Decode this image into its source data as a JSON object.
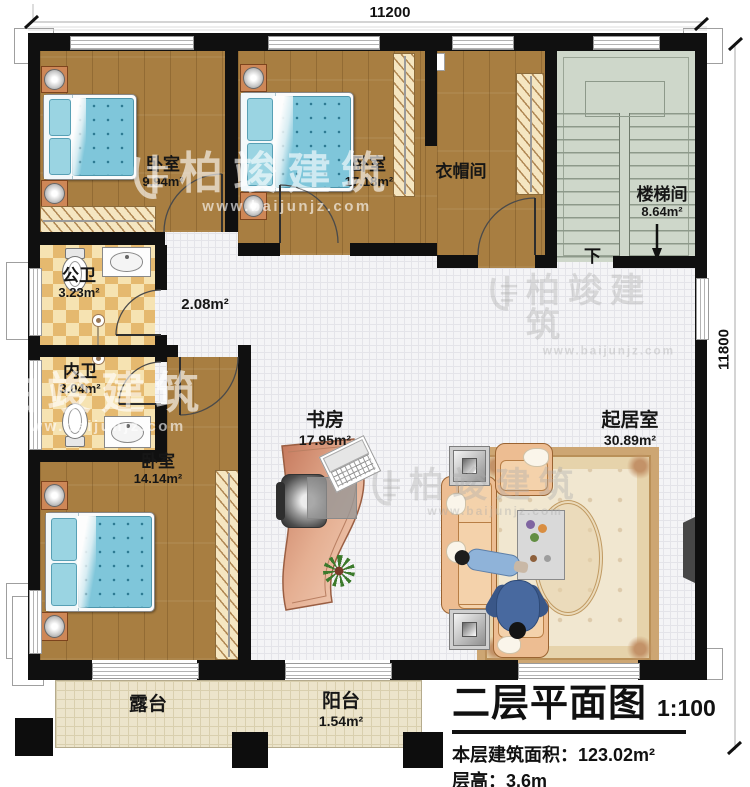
{
  "dimensions": {
    "top": "11200",
    "right": "11800"
  },
  "rooms": {
    "bedroom1": {
      "name": "卧室",
      "area": "9.94m²"
    },
    "bedroom2": {
      "name": "卧室",
      "area": "17.18m²"
    },
    "cloakroom": {
      "name": "衣帽间",
      "area": ""
    },
    "stairwell": {
      "name": "楼梯间",
      "area": "8.64m²"
    },
    "public_bath": {
      "name": "公卫",
      "area": "3.23m²"
    },
    "hallway": {
      "name": "",
      "area": "2.08m²"
    },
    "private_bath": {
      "name": "内卫",
      "area": "3.04m²"
    },
    "bedroom3": {
      "name": "卧室",
      "area": "14.14m²"
    },
    "study": {
      "name": "书房",
      "area": "17.95m²"
    },
    "living_room": {
      "name": "起居室",
      "area": "30.89m²"
    },
    "terrace": {
      "name": "露台",
      "area": ""
    },
    "balcony": {
      "name": "阳台",
      "area": "1.54m²"
    }
  },
  "stairs": {
    "direction_label": "下"
  },
  "title_block": {
    "title": "二层平面图",
    "scale": "1:100",
    "floor_area_label": "本层建筑面积：",
    "floor_area_value": "123.02m²",
    "floor_height_label": "层高：",
    "floor_height_value": "3.6m"
  },
  "watermark": {
    "brand": "柏竣建筑",
    "url": "www.baijunjz.com"
  },
  "colors": {
    "wall": "#101010",
    "wood_floor": "#a87e41",
    "tile_floor": "#f4f4f6",
    "bath_tile": "#e5b96f",
    "stair_floor": "#ced7ca",
    "terrace_floor": "#ece4cb",
    "bed": "#7fc6da",
    "sofa": "#edbd92",
    "desk": "#d99b7c"
  }
}
